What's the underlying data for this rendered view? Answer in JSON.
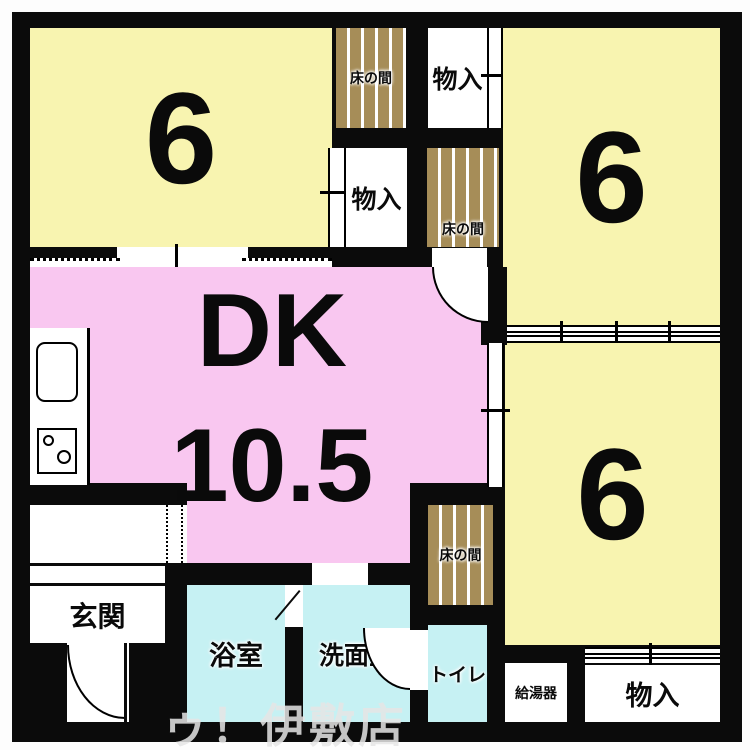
{
  "floorplan": {
    "rooms": {
      "tatami_top_left": "6",
      "tatami_top_right": "6",
      "tatami_bottom_right": "6",
      "dk_line1": "DK",
      "dk_line2": "10.5",
      "entrance": "玄関",
      "bathroom": "浴室",
      "washroom": "洗面室",
      "toilet": "トイレ",
      "water_heater": "給湯器",
      "storage_top": "物入",
      "storage_mid": "物入",
      "storage_bottom": "物入",
      "tokonoma_top": "床の間",
      "tokonoma_mid": "床の間",
      "tokonoma_bottom": "床の間"
    },
    "watermark": "ゥ！伊敷店",
    "colors": {
      "room-yellow": "#f8f4b0",
      "dk-pink": "#f9c7f0",
      "wet-cyan": "#c6f1f3",
      "tokonoma-tan": "#a68d58",
      "wall-black": "#0b0b0b",
      "watermark-gray": "#e6e6e6"
    }
  }
}
